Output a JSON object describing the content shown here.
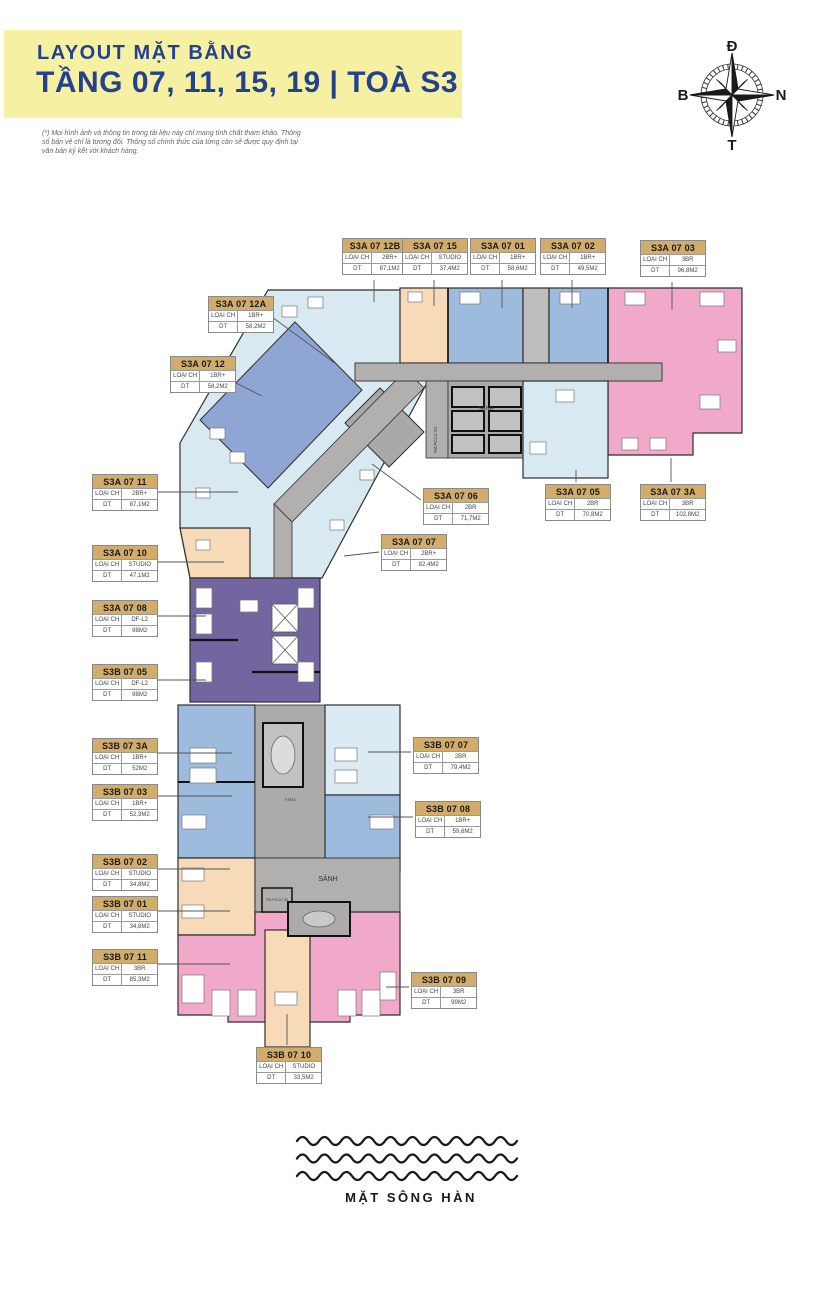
{
  "header": {
    "line1": "LAYOUT MẶT BẰNG",
    "line2": "TẦNG 07, 11, 15, 19 | TOÀ S3"
  },
  "disclaimer": "(*) Mọi hình ảnh và thông tin trong tài liệu này chỉ mang tính chất tham khảo. Thông số bản vẽ chỉ là tương đối. Thông số chính thức của từng căn sẽ được quy định tại văn bản ký kết với khách hàng.",
  "compass": {
    "top": "Đ",
    "right": "N",
    "bottom": "T",
    "left": "B"
  },
  "labels": {
    "type": "LOẠI CH",
    "area": "DT"
  },
  "plan": {
    "lobby_top": "SẢNH",
    "lobby_bottom": "SẢNH",
    "fire_room_top": "TM.PCCC 01",
    "fire_room_bottom": "TM.PCCC 02",
    "trash_room": "F.RÁC"
  },
  "units": [
    {
      "id": "S3A 07 12B",
      "type": "2BR+",
      "area": "87,1M2"
    },
    {
      "id": "S3A 07 15",
      "type": "STUDIO",
      "area": "37,4M2"
    },
    {
      "id": "S3A 07 01",
      "type": "1BR+",
      "area": "58,6M2"
    },
    {
      "id": "S3A 07 02",
      "type": "1BR+",
      "area": "49,5M2"
    },
    {
      "id": "S3A 07 03",
      "type": "3BR",
      "area": "96,8M2"
    },
    {
      "id": "S3A 07 12A",
      "type": "1BR+",
      "area": "58,2M2"
    },
    {
      "id": "S3A 07 12",
      "type": "1BR+",
      "area": "58,2M2"
    },
    {
      "id": "S3A 07 11",
      "type": "2BR+",
      "area": "87,1M2"
    },
    {
      "id": "S3A 07 10",
      "type": "STUDIO",
      "area": "47,1M2"
    },
    {
      "id": "S3A 07 08",
      "type": "DF-L2",
      "area": "98M2"
    },
    {
      "id": "S3B 07 05",
      "type": "DF-L2",
      "area": "98M2"
    },
    {
      "id": "S3A 07 06",
      "type": "2BR",
      "area": "71,7M2"
    },
    {
      "id": "S3A 07 07",
      "type": "2BR+",
      "area": "82,4M2"
    },
    {
      "id": "S3A 07 05",
      "type": "2BR",
      "area": "70,8M2"
    },
    {
      "id": "S3A 07 3A",
      "type": "3BR",
      "area": "102,8M2"
    },
    {
      "id": "S3B 07 3A",
      "type": "1BR+",
      "area": "52M2"
    },
    {
      "id": "S3B 07 03",
      "type": "1BR+",
      "area": "52,3M2"
    },
    {
      "id": "S3B 07 07",
      "type": "2BR",
      "area": "79,4M2"
    },
    {
      "id": "S3B 07 08",
      "type": "1BR+",
      "area": "59,6M2"
    },
    {
      "id": "S3B 07 02",
      "type": "STUDIO",
      "area": "34,8M2"
    },
    {
      "id": "S3B 07 01",
      "type": "STUDIO",
      "area": "34,8M2"
    },
    {
      "id": "S3B 07 11",
      "type": "3BR",
      "area": "85,3M2"
    },
    {
      "id": "S3B 07 09",
      "type": "3BR",
      "area": "99M2"
    },
    {
      "id": "S3B 07 10",
      "type": "STUDIO",
      "area": "33,5M2"
    }
  ],
  "river": {
    "label": "MẶT SÔNG HÀN"
  },
  "colors": {
    "banner": "#F6F0A2",
    "title": "#24418E",
    "label_header": "#D2AC6B",
    "light_blue": "#D9E9F2",
    "medium_blue": "#9DBBDD",
    "stripe_blue": "#8FA6D4",
    "pale_blue": "#DCEAF4",
    "peach": "#F7DBB9",
    "pink": "#F0A9C9",
    "purple": "#73659F",
    "corridor_gray": "#B2B0AF"
  }
}
